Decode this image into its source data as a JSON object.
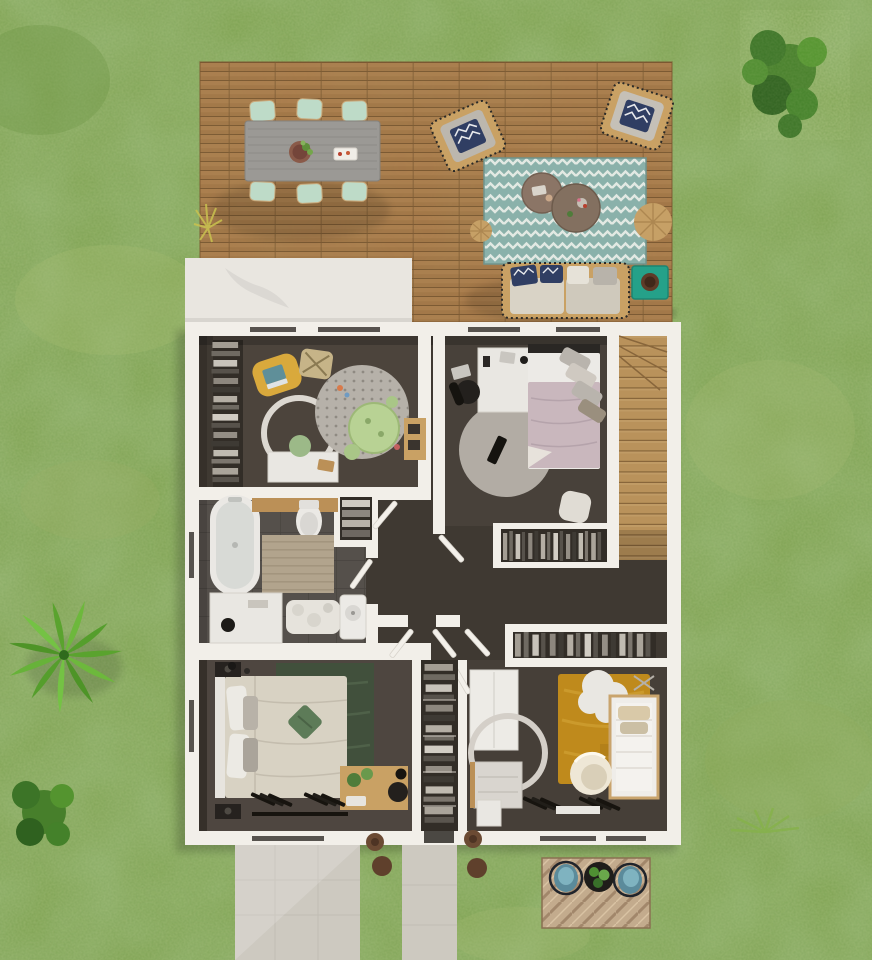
{
  "meta": {
    "kind": "3d-floor-plan-top-view-render",
    "canvas": "872x960"
  },
  "palette": {
    "grass": "#7ca04f",
    "grass_shadow": "#49401a",
    "deck_wood": "#a37647",
    "roof_white": "#e9e6e0",
    "wall_white": "#f2efe9",
    "floor_hall": "#3f3932",
    "floor_room": "#4c443c",
    "floor_master": "#4e4640",
    "floor_nursery": "#463f38",
    "floor_closet": "#322d27",
    "tile_gray": "#55504b",
    "stairs_wood": "#c79e64",
    "rug_teal": "#8ab1aa",
    "rug_round_gray": "#b6b1a9",
    "rug_green_dark": "#41503c",
    "rug_mustard": "#bf8a1c",
    "table_green": "#b8d294",
    "chair_yellow": "#d9a93c",
    "chair_mint": "#bedbc8",
    "table_gray": "#9b9995",
    "bed_mauve": "#c9b7bd",
    "bed_cream": "#d8d2c3",
    "sofa_frame": "#c9a164",
    "cushion_cream": "#d9d3c6",
    "pillow_navy": "#303e63",
    "side_table_teal": "#25a189",
    "path_concrete": "#cdc9c0",
    "patio_tile": "#c3ab8d",
    "planter_brown": "#6b4a33",
    "palm_green": "#5aa32e",
    "bush_green": "#477f2b",
    "white_furniture": "#e9e7e2",
    "wood_mid": "#bb9057",
    "dark_item": "#26221f",
    "pouf_wicker": "#c6a066",
    "mat_beige": "#b2a48d",
    "egg_chair": "#eee7d6",
    "planter_pot": "#8a5a49"
  },
  "outdoor": {
    "lawn": "grass lawn",
    "deck": "wooden terrace deck",
    "dining": {
      "table": "gray plank dining table",
      "chairs": 6,
      "planter": "potted plant centerpiece",
      "tray": "serving tray"
    },
    "lounge": {
      "rug": "teal chevron outdoor rug",
      "armchairs": 2,
      "coffee_tables": 2,
      "poufs": 2,
      "sofa": "fringed outdoor sofa with chevron pillows",
      "side_table": "teal side table with bowl"
    },
    "garden": {
      "palm": "palm plant",
      "bush_top_right": "round bush",
      "bush_bottom_left": "round bush",
      "fern": "fern tuft",
      "grass_tuft": "dry grass tuft on deck edge",
      "shrub_planters": 4
    },
    "paths": [
      "wide concrete path",
      "narrow concrete path"
    ],
    "patio": {
      "surface": "herringbone paver patio",
      "chairs": 2,
      "planter": "round black planter with plants"
    }
  },
  "floorplan": {
    "roof": "white flat roof section",
    "stairs": "wooden winder staircase",
    "hall": {
      "doors": "open white door leaves",
      "wardrobe_upper": "open wardrobe with hanging clothes",
      "wardrobe_lower": "open wardrobe with hanging clothes",
      "console": "wooden hall shelf"
    },
    "rooms": [
      {
        "id": "kids-room",
        "furniture": [
          "wardrobe with hanging clothes",
          "yellow lounge chair with laptop",
          "patterned pouf",
          "round dotted rug",
          "green play table",
          "green stools",
          "round mirror",
          "white desk",
          "green desk chair",
          "wooden tray",
          "toys"
        ]
      },
      {
        "id": "bedroom",
        "furniture": [
          "white desk",
          "black office chair",
          "laptop",
          "double bed with mauve duvet",
          "gray pillows",
          "round gray rug",
          "black remote",
          "white pouf",
          "built-in wardrobe"
        ]
      },
      {
        "id": "bathroom",
        "furniture": [
          "bathtub",
          "wooden counter",
          "toilet",
          "beige bath mat",
          "white vanity",
          "black bin",
          "fluffy rug",
          "washbasin",
          "linen closet with towels"
        ]
      },
      {
        "id": "master-bedroom",
        "furniture": [
          "double bed with cream duvet",
          "green accent pillow",
          "dark green rug",
          "black nightstands",
          "wooden desk with plants",
          "black chair",
          "black console"
        ]
      },
      {
        "id": "walk-in-closet",
        "furniture": [
          "shelves with folded clothes"
        ]
      },
      {
        "id": "nursery",
        "furniture": [
          "white wardrobe",
          "changing dresser",
          "round mirror",
          "mustard rug",
          "cloud rug",
          "crib with mobile",
          "egg chair",
          "black console"
        ]
      }
    ]
  }
}
